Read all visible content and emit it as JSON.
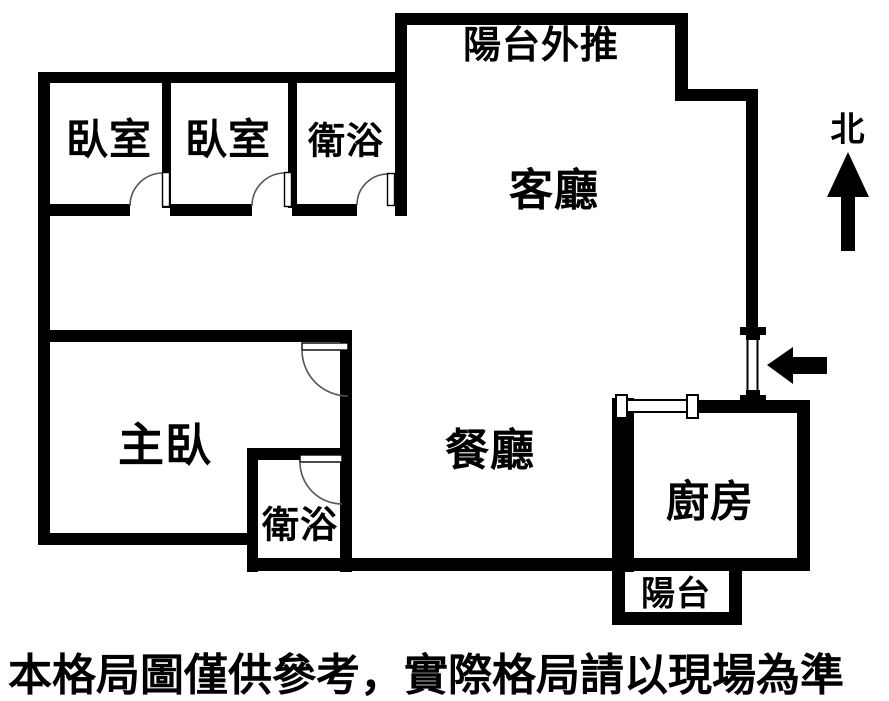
{
  "title": "apartment-floor-plan",
  "colors": {
    "wall": "#000000",
    "text": "#000000",
    "background": "#ffffff",
    "door_arc": "#555555"
  },
  "labels": {
    "balcony_out": "陽台外推",
    "bedroom_a": "臥室",
    "bedroom_b": "臥室",
    "bath_a": "衛浴",
    "living": "客廳",
    "master": "主臥",
    "dining": "餐廳",
    "kitchen": "廚房",
    "bath_b": "衛浴",
    "balcony": "陽台",
    "north": "北",
    "disclaimer": "本格局圖僅供參考，實際格局請以現場為準"
  },
  "icons": {
    "north_arrow": "north-arrow-icon",
    "entrance_arrow": "entrance-arrow-icon",
    "swing_door": "door-swing-arc",
    "sliding_door": "sliding-door-symbol",
    "entry_door": "entry-door-symbol"
  }
}
